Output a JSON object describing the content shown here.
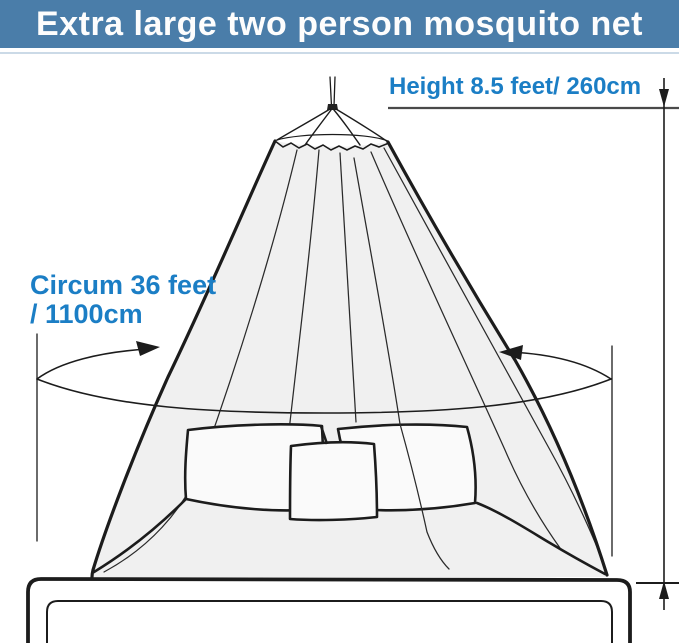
{
  "title": {
    "text": "Extra large two person mosquito net",
    "banner_color": "#4a7da9",
    "text_color": "#fdfdfd"
  },
  "diagram": {
    "subject": "conical mosquito net canopy hanging over a double bed with three pillows",
    "label_color": "#1b7ec5",
    "net_fill_color": "#f0f0f0",
    "line_color": "#1c1c1c",
    "measurements": {
      "height_label": "Height 8.5 feet/ 260cm",
      "circumference_label_line1": "Circum 36 feet",
      "circumference_label_line2": "/ 1100cm"
    }
  }
}
